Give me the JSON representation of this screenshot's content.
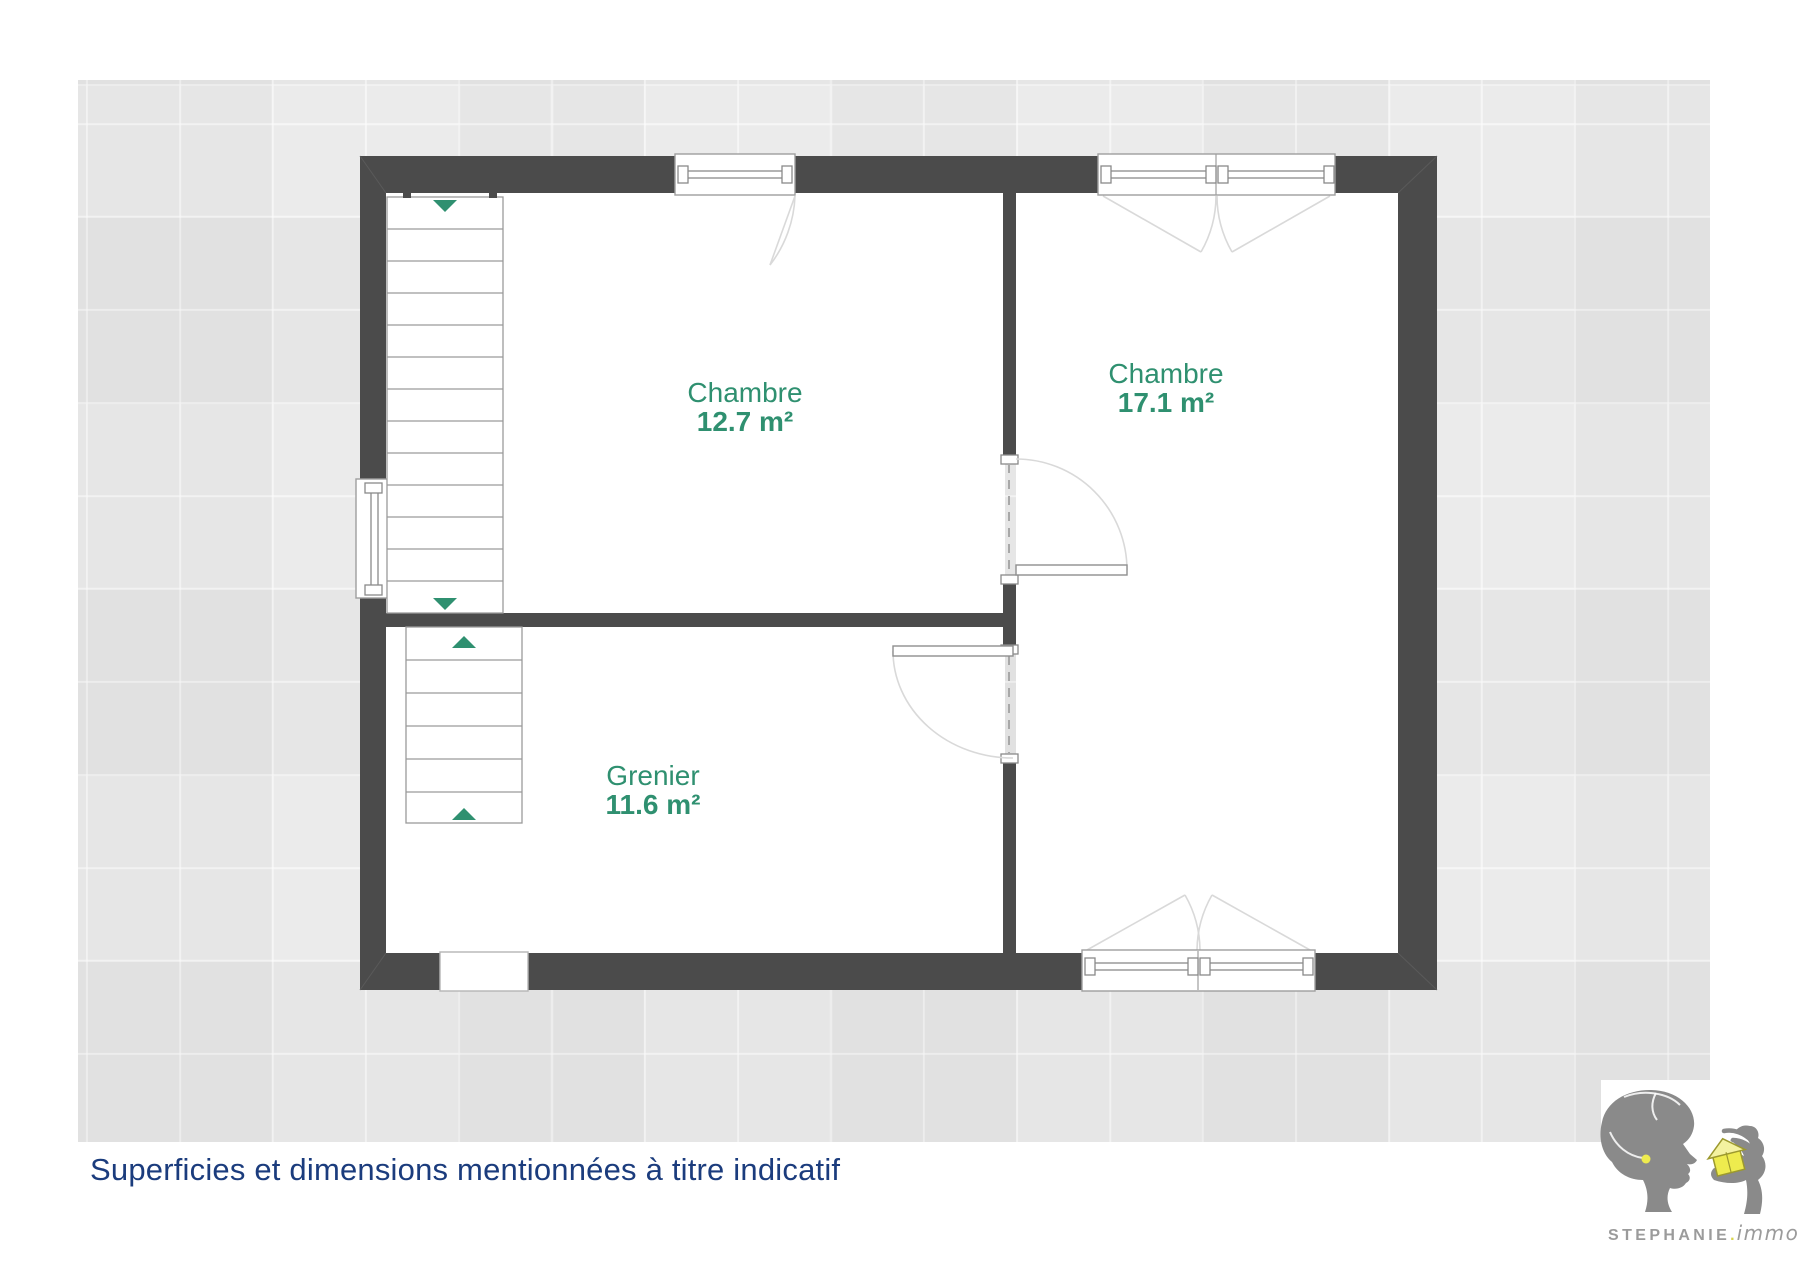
{
  "plan": {
    "rooms": [
      {
        "name": "Chambre",
        "area": "12.7 m²"
      },
      {
        "name": "Chambre",
        "area": "17.1 m²"
      },
      {
        "name": "Grenier",
        "area": "11.6 m²"
      }
    ]
  },
  "caption": {
    "text": "Superficies et dimensions mentionnées à titre indicatif"
  },
  "logo": {
    "brand": "STEPHANIE",
    "separator": ".",
    "suffix": "immo"
  },
  "colors": {
    "wall": "#4b4b4b",
    "canvas-bg": "#e9e9e9",
    "room-label": "#2f9070",
    "caption": "#1b3c7d",
    "outline": "#999999",
    "logo-gray": "#8a8a8a",
    "logo-text": "#9b9b9b",
    "logo-yellow": "#eeeb4e"
  }
}
